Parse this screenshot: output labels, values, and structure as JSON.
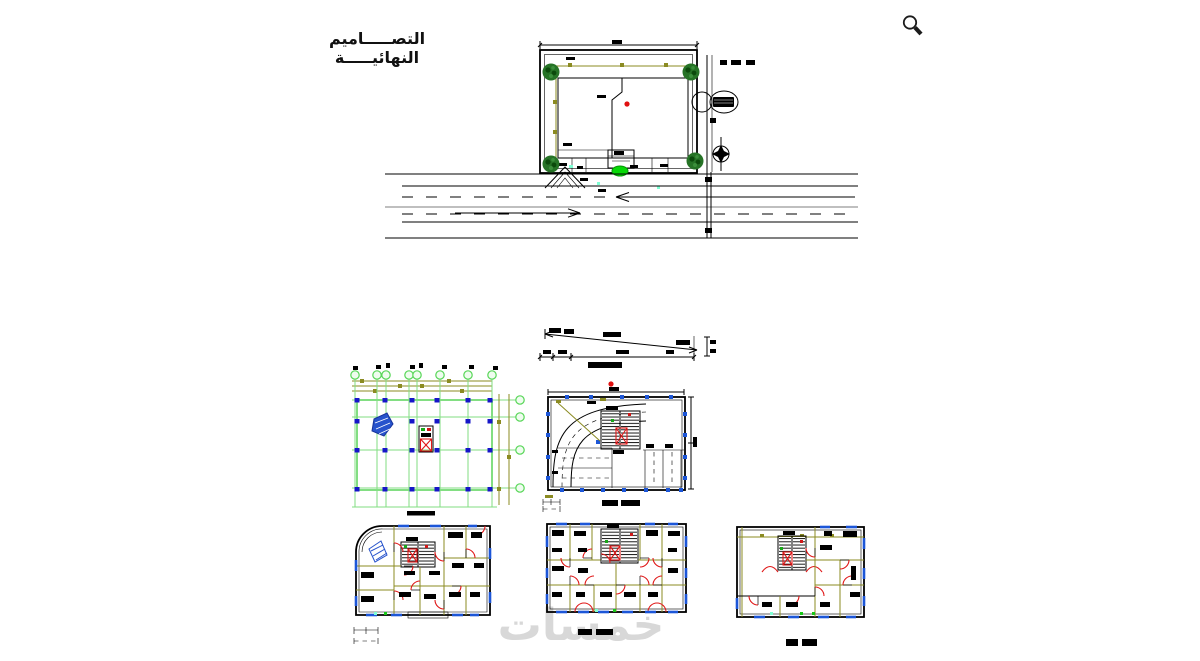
{
  "page": {
    "width": 1200,
    "height": 661,
    "background": "#ffffff"
  },
  "header": {
    "title": "التصـــــاميم النهائيـــــة"
  },
  "watermark": {
    "text": "خمسات",
    "color": "#d8d8d8"
  },
  "icons": {
    "magnifier": "magnifier-icon",
    "north_arrow": "north-arrow-icon",
    "tree": "tree-icon"
  },
  "colors": {
    "linework": "#000000",
    "grid_green": "#82de82",
    "dimension_olive": "#8b8b22",
    "column_blue": "#1616c8",
    "window_blue": "#1c56d8",
    "door_red": "#e01818",
    "tree_green": "#267326",
    "shrub_green": "#07d907",
    "accent_aqua": "#7fffd4",
    "marker_red": "#e01010",
    "watermark_gray": "#d8d8d8"
  }
}
